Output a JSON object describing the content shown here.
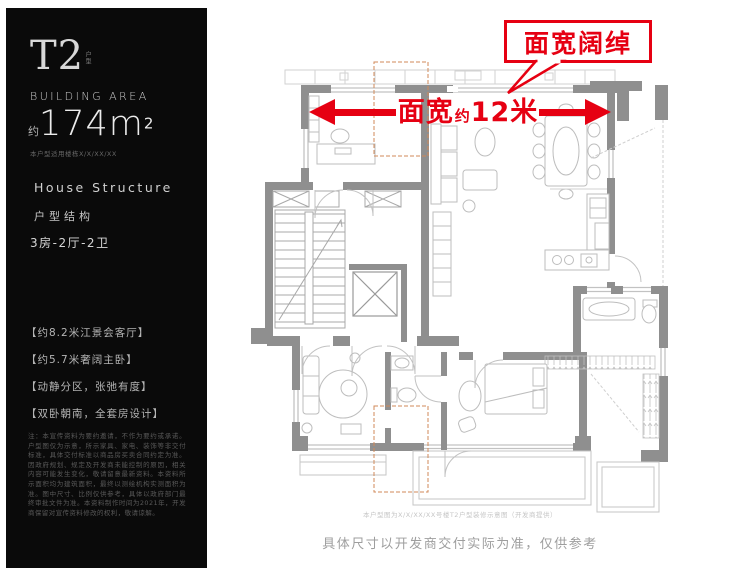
{
  "sidebar": {
    "unit_type": "T2",
    "unit_type_sub": "户型",
    "building_area_label": "BUILDING AREA",
    "area_approx": "约",
    "area_value": "174m",
    "area_sup": "2",
    "area_note": "本户型适用楼栋X/X/XX/XX",
    "house_structure_en": "House Structure",
    "house_structure_cn": "户型结构",
    "layout_spec": "3房-2厅-2卫",
    "features": [
      "【约8.2米江景会客厅】",
      "【约5.7米奢阔主卧】",
      "【动静分区，张弛有度】",
      "【双卧朝南，全套房设计】"
    ],
    "disclaimer": "注：本宣传资料为要约邀请，不作为要约或承诺。户型图仅为示意，所示家具、家电、装饰等非交付标准，具体交付标准以商品房买卖合同约定为准。因政府规划、规定及开发商未能控制的原因，相关内容可能发生变化，敬请留意最新资料。本资料所示面积均为建筑面积，最终以测绘机构实测面积为准。图中尺寸、比例仅供参考，具体以政府部门最终审批文件为准。本资料制作时间为2021年，开发商保留对宣传资料修改的权利，敬请谅解。"
  },
  "plan": {
    "callout_label": "面宽阔绰",
    "dimension": {
      "prefix": "面宽",
      "approx": "约",
      "value": "12米"
    }
  },
  "footer": {
    "source_note": "本户型图为X/X/XX/XX号楼T2户型装修示意图（开发商提供）",
    "disclaimer": "具体尺寸以开发商交付实际为准，仅供参考"
  },
  "colors": {
    "accent_red": "#e60012",
    "wall_gray": "#8f8f8f",
    "sidebar_black": "#0a0a0a"
  }
}
